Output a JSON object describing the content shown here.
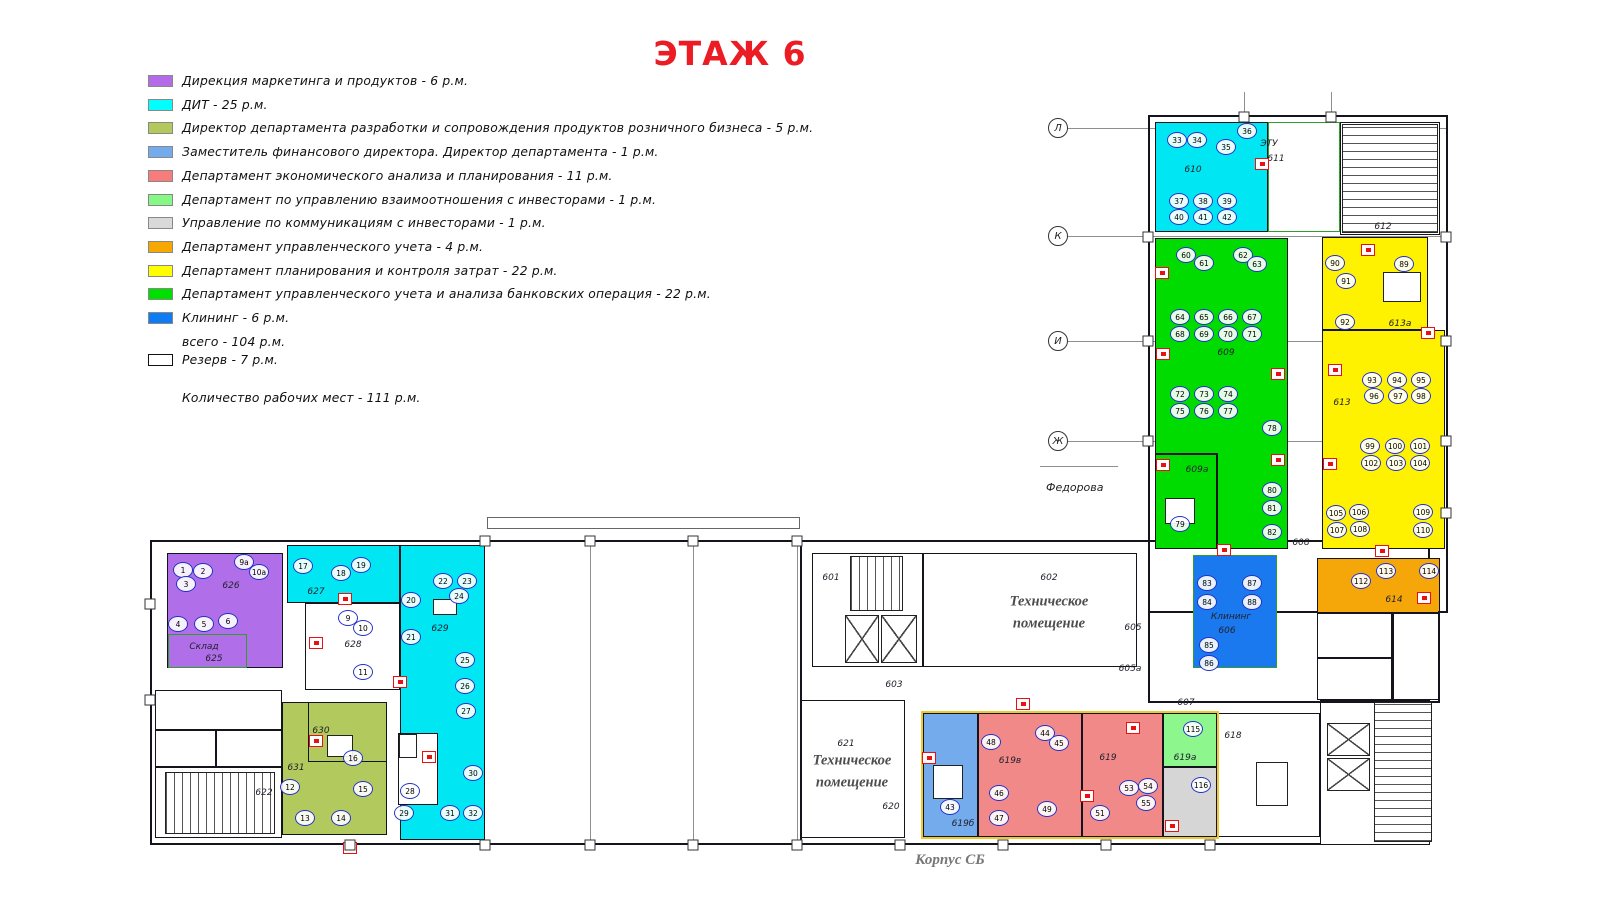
{
  "title": {
    "text": "ЭТАЖ 6",
    "color": "#ec1c24"
  },
  "legend": {
    "items": [
      {
        "color": "#b36be8",
        "label": "Дирекция маркетинга и продуктов  - 6 р.м."
      },
      {
        "color": "#00ffff",
        "label": "ДИТ - 25 р.м."
      },
      {
        "color": "#b2c95e",
        "label": "Директор департамента разработки и сопровождения продуктов розничного бизнеса -  5 р.м."
      },
      {
        "color": "#74abec",
        "label": "Заместитель финансового директора. Директор департамента  - 1 р.м."
      },
      {
        "color": "#f87c7c",
        "label": "Департамент экономического анализа и планирования - 11 р.м."
      },
      {
        "color": "#86f886",
        "label": "Департамент по управлению взаимоотношения с инвесторами - 1 р.м."
      },
      {
        "color": "#d9d9d9",
        "label": "Управление по коммуникациям с инвесторами - 1 р.м."
      },
      {
        "color": "#f6a800",
        "label": "Департамент управленческого учета - 4 р.м."
      },
      {
        "color": "#ffff00",
        "label": "Департамент планирования и контроля затрат - 22 р.м."
      },
      {
        "color": "#00e000",
        "label": "Департамент управленческого учета и анализа банковских операция - 22 р.м."
      },
      {
        "color": "#0f7cf4",
        "label": "Клининг - 6 р.м."
      }
    ],
    "total_label": "всего  - 104 р.м.",
    "reserve_label": "Резерв - 7 р.м.",
    "workplaces_label": "Количество рабочих мест - 111 р.м."
  },
  "floorplan": {
    "grid_markers": [
      {
        "label": "Л",
        "x": 1058,
        "y": 128
      },
      {
        "label": "К",
        "x": 1058,
        "y": 236
      },
      {
        "label": "И",
        "x": 1058,
        "y": 341
      },
      {
        "label": "Ж",
        "x": 1058,
        "y": 441
      }
    ],
    "grid_lines": [
      [
        1067,
        128,
        381
      ],
      [
        1067,
        236,
        381
      ],
      [
        1067,
        341,
        381
      ],
      [
        1067,
        441,
        381
      ],
      [
        1040,
        466,
        78
      ]
    ],
    "faint_vlines": [
      [
        590,
        546,
        297
      ],
      [
        693,
        546,
        297
      ],
      [
        797,
        546,
        297
      ],
      [
        1244,
        92,
        24
      ],
      [
        1331,
        92,
        24
      ]
    ],
    "street_label": {
      "text": "Федорова",
      "x": 1046,
      "y": 481
    },
    "corpus_label": {
      "text": "Корпус СБ",
      "x": 910,
      "y": 850
    },
    "walls_under": [
      [
        150,
        540,
        1280,
        305,
        "#14141c",
        2
      ],
      [
        1148,
        115,
        300,
        498,
        "#14141c",
        2
      ]
    ],
    "walls_over": [
      [
        1148,
        611,
        2,
        92
      ],
      [
        1438,
        611,
        2,
        92
      ],
      [
        1150,
        701,
        290,
        2
      ],
      [
        800,
        543,
        2,
        302
      ],
      [
        1155,
        453,
        62,
        2
      ],
      [
        1216,
        453,
        2,
        96
      ],
      [
        1392,
        613,
        2,
        87
      ],
      [
        1317,
        657,
        76,
        2
      ],
      [
        155,
        729,
        127,
        2
      ],
      [
        155,
        766,
        127,
        2
      ],
      [
        215,
        729,
        2,
        38
      ]
    ],
    "outlines_over": [
      [
        921,
        711,
        298,
        128,
        "#edc92f",
        2
      ],
      [
        487,
        517,
        313,
        12,
        "#666666",
        1
      ]
    ],
    "rooms": [
      [
        "room-610",
        1155,
        122,
        113,
        110,
        "#00e6f2",
        ""
      ],
      [
        "room-611",
        1268,
        122,
        72,
        110,
        "#ffffff",
        "#2f9e2f"
      ],
      [
        "room-612",
        1340,
        122,
        100,
        113,
        "#ffffff",
        ""
      ],
      [
        "room-609",
        1155,
        238,
        133,
        311,
        "#00dc00",
        ""
      ],
      [
        "room-613a",
        1322,
        237,
        106,
        93,
        "#fef201",
        ""
      ],
      [
        "room-613",
        1322,
        330,
        123,
        219,
        "#fef201",
        ""
      ],
      [
        "room-606",
        1193,
        555,
        84,
        113,
        "#1b79f0",
        "#2f9e2f"
      ],
      [
        "room-614",
        1317,
        558,
        123,
        55,
        "#f5a70a",
        ""
      ],
      [
        "room-wc-left",
        1317,
        613,
        75,
        87,
        "#ffffff",
        ""
      ],
      [
        "room-wc-right",
        1392,
        613,
        48,
        87,
        "#ffffff",
        ""
      ],
      [
        "room-626",
        167,
        553,
        116,
        115,
        "#b06ee8",
        ""
      ],
      [
        "room-625",
        168,
        634,
        79,
        34,
        "#b06ee8",
        "#2f9e2f"
      ],
      [
        "room-627",
        287,
        545,
        113,
        58,
        "#00e6f2",
        ""
      ],
      [
        "room-629",
        400,
        545,
        85,
        295,
        "#00e6f2",
        ""
      ],
      [
        "room-628",
        305,
        603,
        95,
        87,
        "#ffffff",
        ""
      ],
      [
        "room-629-notch",
        398,
        733,
        40,
        72,
        "#ffffff",
        ""
      ],
      [
        "room-631",
        282,
        702,
        105,
        133,
        "#b2c95e",
        ""
      ],
      [
        "room-630",
        308,
        702,
        79,
        60,
        "#b2c95e",
        ""
      ],
      [
        "room-622",
        155,
        690,
        127,
        148,
        "#ffffff",
        ""
      ],
      [
        "room-601",
        812,
        553,
        111,
        114,
        "#ffffff",
        ""
      ],
      [
        "room-602",
        923,
        553,
        214,
        114,
        "#ffffff",
        ""
      ],
      [
        "room-621",
        800,
        700,
        105,
        138,
        "#ffffff",
        ""
      ],
      [
        "room-619b",
        923,
        713,
        55,
        124,
        "#74abec",
        ""
      ],
      [
        "room-619v",
        978,
        713,
        104,
        124,
        "#f28989",
        ""
      ],
      [
        "room-619",
        1082,
        713,
        81,
        124,
        "#f28989",
        ""
      ],
      [
        "room-619a-green",
        1163,
        713,
        54,
        54,
        "#8df68d",
        ""
      ],
      [
        "room-619a-gray",
        1163,
        767,
        54,
        70,
        "#d6d6d6",
        ""
      ],
      [
        "room-618",
        1217,
        713,
        103,
        124,
        "#ffffff",
        ""
      ],
      [
        "room-lift-block",
        1320,
        700,
        110,
        145,
        "#ffffff",
        ""
      ]
    ],
    "room_labels": [
      [
        "610",
        1193,
        170
      ],
      [
        "ЭТУ",
        1269,
        144
      ],
      [
        "611",
        1276,
        159
      ],
      [
        "612",
        1383,
        227
      ],
      [
        "609",
        1226,
        353
      ],
      [
        "609а",
        1197,
        470
      ],
      [
        "613а",
        1400,
        324
      ],
      [
        "613",
        1342,
        403
      ],
      [
        "608",
        1301,
        543
      ],
      [
        "Клининг",
        1231,
        617
      ],
      [
        "606",
        1227,
        631
      ],
      [
        "614",
        1394,
        600
      ],
      [
        "605",
        1133,
        628
      ],
      [
        "605а",
        1130,
        669
      ],
      [
        "607",
        1186,
        703
      ],
      [
        "626",
        231,
        586
      ],
      [
        "Склад",
        204,
        647
      ],
      [
        "625",
        214,
        659
      ],
      [
        "627",
        316,
        592
      ],
      [
        "628",
        353,
        645
      ],
      [
        "629",
        440,
        629
      ],
      [
        "630",
        321,
        731
      ],
      [
        "631",
        296,
        768
      ],
      [
        "622",
        264,
        793
      ],
      [
        "601",
        831,
        578
      ],
      [
        "602",
        1049,
        578
      ],
      [
        "603",
        894,
        685
      ],
      [
        "621",
        846,
        744
      ],
      [
        "620",
        891,
        807
      ],
      [
        "619б",
        963,
        824
      ],
      [
        "619в",
        1010,
        761
      ],
      [
        "619",
        1108,
        758
      ],
      [
        "619а",
        1185,
        758
      ],
      [
        "618",
        1233,
        736
      ]
    ],
    "tech_labels": [
      {
        "text": "Техническое помещение",
        "x": 1049,
        "y": 613
      },
      {
        "text": "Техническое помещение",
        "x": 852,
        "y": 772
      }
    ],
    "stairs": [
      [
        1342,
        124,
        96,
        109,
        "h"
      ],
      [
        850,
        556,
        53,
        55,
        "v"
      ],
      [
        165,
        772,
        110,
        62,
        "v"
      ],
      [
        1374,
        702,
        58,
        140,
        "h"
      ]
    ],
    "lifts": [
      [
        845,
        615,
        34,
        48
      ],
      [
        881,
        615,
        36,
        48
      ],
      [
        1327,
        723,
        43,
        33
      ],
      [
        1327,
        758,
        43,
        33
      ]
    ],
    "tables": [
      [
        1383,
        272,
        38,
        30
      ],
      [
        327,
        735,
        26,
        22
      ],
      [
        1256,
        762,
        32,
        44
      ],
      [
        933,
        765,
        30,
        34
      ],
      [
        1165,
        498,
        30,
        26
      ]
    ],
    "reserve_desks": [
      [
        408,
        746,
        16,
        22
      ],
      [
        445,
        607,
        22,
        14
      ]
    ],
    "desks": [
      [
        "33",
        1177,
        140
      ],
      [
        "34",
        1197,
        140
      ],
      [
        "35",
        1226,
        147
      ],
      [
        "36",
        1247,
        131
      ],
      [
        "37",
        1179,
        201
      ],
      [
        "38",
        1203,
        201
      ],
      [
        "39",
        1227,
        201
      ],
      [
        "40",
        1179,
        217
      ],
      [
        "41",
        1203,
        217
      ],
      [
        "42",
        1227,
        217
      ],
      [
        "60",
        1186,
        255
      ],
      [
        "61",
        1204,
        263
      ],
      [
        "62",
        1243,
        255
      ],
      [
        "63",
        1257,
        264
      ],
      [
        "64",
        1180,
        317
      ],
      [
        "65",
        1204,
        317
      ],
      [
        "66",
        1228,
        317
      ],
      [
        "67",
        1252,
        317
      ],
      [
        "68",
        1180,
        334
      ],
      [
        "69",
        1204,
        334
      ],
      [
        "70",
        1228,
        334
      ],
      [
        "71",
        1252,
        334
      ],
      [
        "72",
        1180,
        394
      ],
      [
        "73",
        1204,
        394
      ],
      [
        "74",
        1228,
        394
      ],
      [
        "75",
        1180,
        411
      ],
      [
        "76",
        1204,
        411
      ],
      [
        "77",
        1228,
        411
      ],
      [
        "78",
        1272,
        428
      ],
      [
        "79",
        1180,
        524
      ],
      [
        "80",
        1272,
        490
      ],
      [
        "81",
        1272,
        508
      ],
      [
        "82",
        1272,
        532
      ],
      [
        "89",
        1404,
        264
      ],
      [
        "90",
        1335,
        263
      ],
      [
        "91",
        1346,
        281
      ],
      [
        "92",
        1345,
        322
      ],
      [
        "93",
        1372,
        380
      ],
      [
        "94",
        1397,
        380
      ],
      [
        "95",
        1421,
        380
      ],
      [
        "96",
        1374,
        396
      ],
      [
        "97",
        1398,
        396
      ],
      [
        "98",
        1421,
        396
      ],
      [
        "99",
        1370,
        446
      ],
      [
        "100",
        1395,
        446
      ],
      [
        "101",
        1420,
        446
      ],
      [
        "102",
        1371,
        463
      ],
      [
        "103",
        1396,
        463
      ],
      [
        "104",
        1420,
        463
      ],
      [
        "105",
        1336,
        513
      ],
      [
        "106",
        1359,
        512
      ],
      [
        "107",
        1337,
        530
      ],
      [
        "108",
        1360,
        529
      ],
      [
        "109",
        1423,
        512
      ],
      [
        "110",
        1423,
        530
      ],
      [
        "83",
        1207,
        583
      ],
      [
        "84",
        1207,
        602
      ],
      [
        "85",
        1209,
        645
      ],
      [
        "86",
        1209,
        663
      ],
      [
        "87",
        1252,
        583
      ],
      [
        "88",
        1252,
        602
      ],
      [
        "112",
        1361,
        581
      ],
      [
        "113",
        1386,
        571
      ],
      [
        "114",
        1429,
        571
      ],
      [
        "1",
        183,
        570
      ],
      [
        "2",
        203,
        571
      ],
      [
        "3",
        186,
        584
      ],
      [
        "4",
        178,
        624
      ],
      [
        "5",
        204,
        624
      ],
      [
        "6",
        228,
        621
      ],
      [
        "9а",
        244,
        562
      ],
      [
        "10а",
        259,
        572
      ],
      [
        "17",
        303,
        566
      ],
      [
        "18",
        341,
        573
      ],
      [
        "19",
        361,
        565
      ],
      [
        "9",
        348,
        618
      ],
      [
        "10",
        363,
        628
      ],
      [
        "11",
        363,
        672
      ],
      [
        "20",
        411,
        600
      ],
      [
        "21",
        411,
        637
      ],
      [
        "22",
        443,
        581
      ],
      [
        "23",
        467,
        581
      ],
      [
        "24",
        459,
        596
      ],
      [
        "25",
        465,
        660
      ],
      [
        "26",
        465,
        686
      ],
      [
        "27",
        466,
        711
      ],
      [
        "28",
        410,
        791
      ],
      [
        "29",
        404,
        813
      ],
      [
        "30",
        473,
        773
      ],
      [
        "31",
        450,
        813
      ],
      [
        "32",
        473,
        813
      ],
      [
        "12",
        290,
        787
      ],
      [
        "13",
        305,
        818
      ],
      [
        "14",
        341,
        818
      ],
      [
        "15",
        363,
        789
      ],
      [
        "16",
        353,
        758
      ],
      [
        "43",
        950,
        807
      ],
      [
        "44",
        1045,
        733
      ],
      [
        "45",
        1059,
        743
      ],
      [
        "46",
        999,
        793
      ],
      [
        "47",
        999,
        818
      ],
      [
        "48",
        991,
        742
      ],
      [
        "49",
        1047,
        809
      ],
      [
        "51",
        1100,
        813
      ],
      [
        "53",
        1129,
        788
      ],
      [
        "54",
        1148,
        786
      ],
      [
        "55",
        1146,
        803
      ],
      [
        "115",
        1193,
        729
      ],
      [
        "116",
        1201,
        785
      ]
    ],
    "extinguishers": [
      [
        1262,
        164
      ],
      [
        1162,
        273
      ],
      [
        1163,
        354
      ],
      [
        1163,
        465
      ],
      [
        1224,
        550
      ],
      [
        1278,
        374
      ],
      [
        1278,
        460
      ],
      [
        1368,
        250
      ],
      [
        1335,
        370
      ],
      [
        1330,
        464
      ],
      [
        1428,
        333
      ],
      [
        1382,
        551
      ],
      [
        1424,
        598
      ],
      [
        345,
        599
      ],
      [
        316,
        643
      ],
      [
        400,
        682
      ],
      [
        429,
        757
      ],
      [
        316,
        741
      ],
      [
        350,
        848
      ],
      [
        929,
        758
      ],
      [
        1023,
        704
      ],
      [
        1087,
        796
      ],
      [
        1133,
        728
      ],
      [
        1172,
        826
      ]
    ],
    "ticks": [
      [
        350,
        845
      ],
      [
        485,
        845
      ],
      [
        590,
        845
      ],
      [
        693,
        845
      ],
      [
        797,
        845
      ],
      [
        900,
        845
      ],
      [
        1003,
        845
      ],
      [
        1106,
        845
      ],
      [
        1210,
        845
      ],
      [
        485,
        541
      ],
      [
        590,
        541
      ],
      [
        693,
        541
      ],
      [
        797,
        541
      ],
      [
        150,
        604
      ],
      [
        150,
        700
      ],
      [
        1148,
        237
      ],
      [
        1148,
        341
      ],
      [
        1148,
        441
      ],
      [
        1446,
        237
      ],
      [
        1446,
        341
      ],
      [
        1446,
        441
      ],
      [
        1446,
        513
      ],
      [
        1244,
        117
      ],
      [
        1331,
        117
      ]
    ]
  }
}
